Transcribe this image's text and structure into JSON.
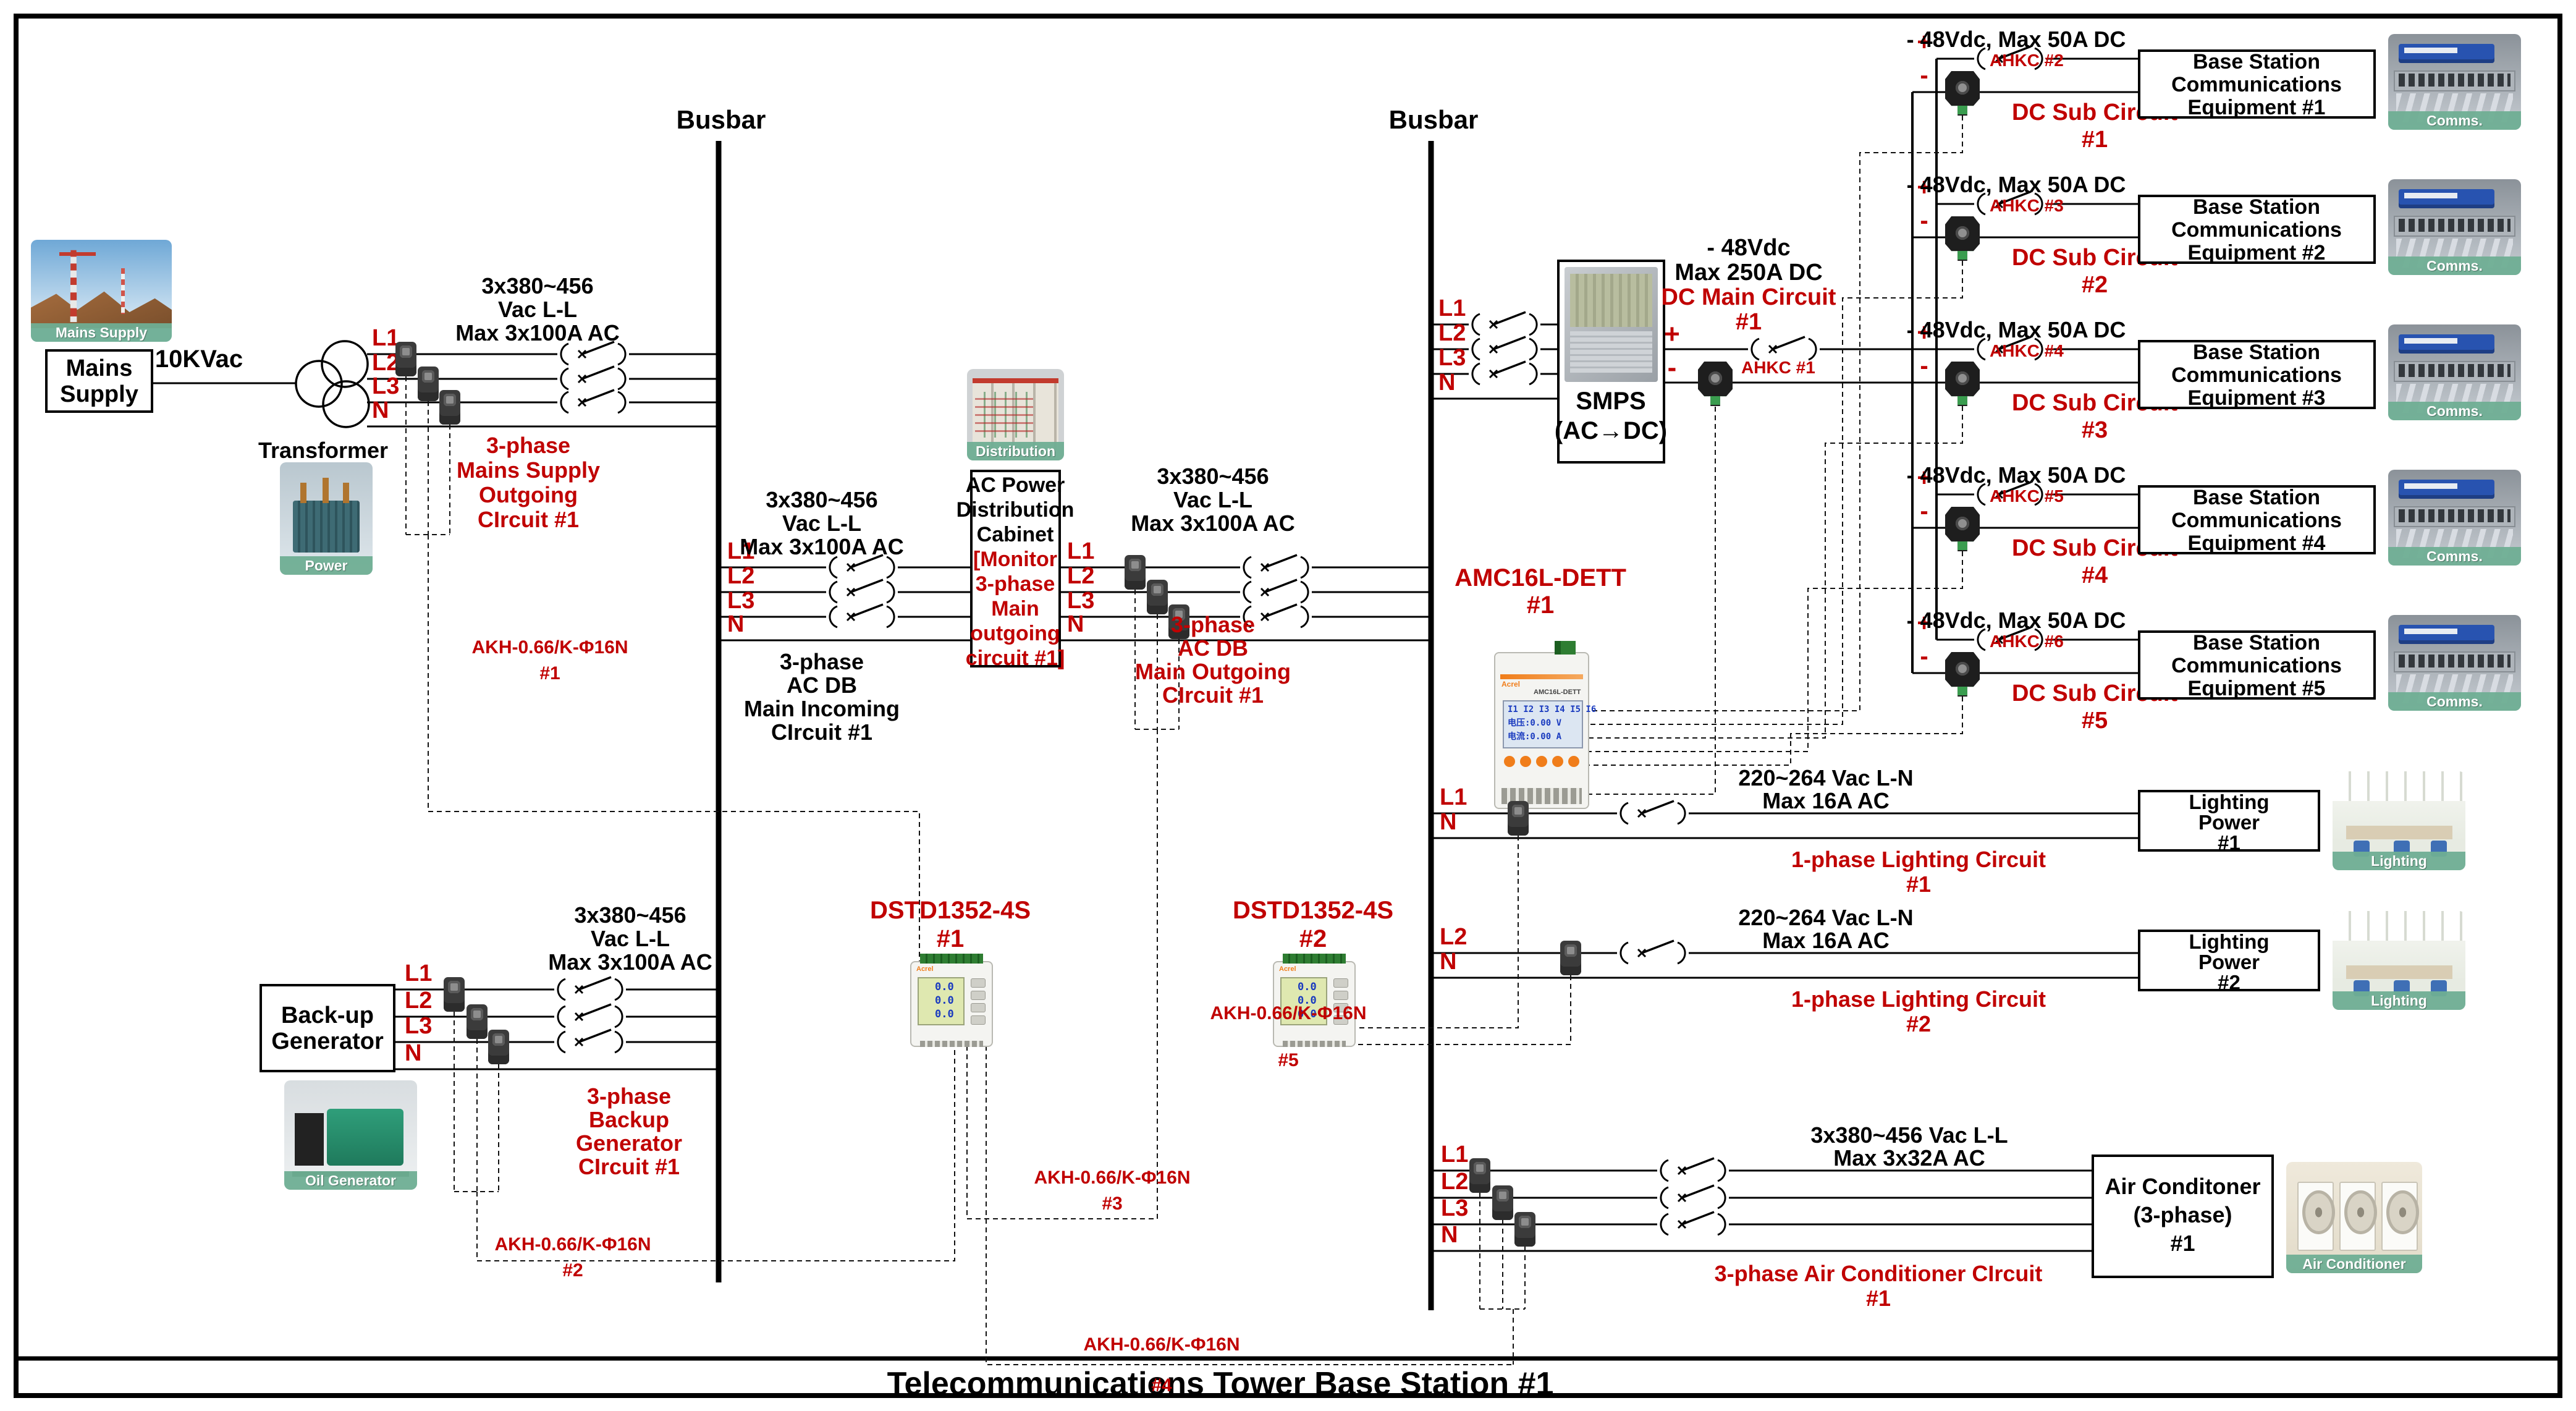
{
  "header": {
    "title": "Telecommunications Tower Base Station #1"
  },
  "busbar_label": "Busbar",
  "colors": {
    "red": "#c00000",
    "black": "#000000",
    "caption_green": "#6fae94"
  },
  "phases": [
    "L1",
    "L2",
    "L3",
    "N"
  ],
  "spec_380_100": [
    "3x380~456",
    "Vac L-L",
    "Max 3x100A AC"
  ],
  "mains": {
    "source_box": [
      "Mains",
      "Supply"
    ],
    "photo_caption": "Mains Supply",
    "voltage": "10KVac",
    "transformer_label": "Transformer",
    "transformer_photo_caption": "Power Transformer",
    "circuit": [
      "3-phase",
      "Mains Supply",
      "Outgoing",
      "CIrcuit #1"
    ]
  },
  "incoming": {
    "circuit": [
      "3-phase",
      "AC DB",
      "Main Incoming",
      "CIrcuit #1"
    ],
    "cabinet_black": [
      "AC Power",
      "Distribution",
      "Cabinet"
    ],
    "cabinet_red": [
      "[Monitor",
      "3-phase",
      "Main",
      "outgoing",
      "circuit #1]"
    ],
    "cabinet_photo_caption": "Distribution Cabinet"
  },
  "outgoing": {
    "circuit": [
      "3-phase",
      "AC DB",
      "Main Outgoing",
      "CIrcuit #1"
    ]
  },
  "generator": {
    "source_box": [
      "Back-up",
      "Generator"
    ],
    "photo_caption": "Oil Generator",
    "circuit": [
      "3-phase",
      "Backup",
      "Generator",
      "CIrcuit #1"
    ]
  },
  "smps": {
    "box": [
      "SMPS",
      "(AC→DC)"
    ],
    "spec_black": [
      "- 48Vdc",
      "Max 250A DC"
    ],
    "spec_red": [
      "DC Main Circuit",
      "#1"
    ],
    "plus": "+",
    "minus": "-",
    "ahkc": "AHKC #1"
  },
  "akh": {
    "model": "AKH-0.66/K-Φ16N",
    "nums": [
      "#1",
      "#2",
      "#3",
      "#4",
      "#5"
    ]
  },
  "dc_subcircuits": [
    {
      "spec": "- 48Vdc, Max 50A DC",
      "plus": "+",
      "minus": "-",
      "ahkc": "AHKC #2",
      "name": [
        "DC Sub Circuit",
        "#1"
      ],
      "equipment": [
        "Base Station",
        "Communications",
        "Equipment #1"
      ],
      "photo_caption": "Comms. Equipment"
    },
    {
      "spec": "- 48Vdc, Max 50A DC",
      "plus": "+",
      "minus": "-",
      "ahkc": "AHKC #3",
      "name": [
        "DC Sub Circuit",
        "#2"
      ],
      "equipment": [
        "Base Station",
        "Communications",
        "Equipment #2"
      ],
      "photo_caption": "Comms. Equipment"
    },
    {
      "spec": "- 48Vdc, Max 50A DC",
      "plus": "+",
      "minus": "-",
      "ahkc": "AHKC #4",
      "name": [
        "DC Sub Circuit",
        "#3"
      ],
      "equipment": [
        "Base Station",
        "Communications",
        "Equipment #3"
      ],
      "photo_caption": "Comms. Equipment"
    },
    {
      "spec": "- 48Vdc, Max 50A DC",
      "plus": "+",
      "minus": "-",
      "ahkc": "AHKC #5",
      "name": [
        "DC Sub Circuit",
        "#4"
      ],
      "equipment": [
        "Base Station",
        "Communications",
        "Equipment #4"
      ],
      "photo_caption": "Comms. Equipment"
    },
    {
      "spec": "- 48Vdc, Max 50A DC",
      "plus": "+",
      "minus": "-",
      "ahkc": "AHKC #6",
      "name": [
        "DC Sub Circuit",
        "#5"
      ],
      "equipment": [
        "Base Station",
        "Communications",
        "Equipment #5"
      ],
      "photo_caption": "Comms. Equipment"
    }
  ],
  "lighting": [
    {
      "phase": "L1",
      "neutral": "N",
      "spec": [
        "220~264 Vac L-N",
        "Max 16A AC"
      ],
      "circuit": [
        "1-phase Lighting Circuit",
        "#1"
      ],
      "box": [
        "Lighting",
        "Power",
        "#1"
      ],
      "photo_caption": "Lighting"
    },
    {
      "phase": "L2",
      "neutral": "N",
      "spec": [
        "220~264 Vac L-N",
        "Max 16A AC"
      ],
      "circuit": [
        "1-phase Lighting Circuit",
        "#2"
      ],
      "box": [
        "Lighting",
        "Power",
        "#2"
      ],
      "photo_caption": "Lighting"
    }
  ],
  "aircon": {
    "spec": [
      "3x380~456 Vac L-L",
      "Max 3x32A AC"
    ],
    "circuit": [
      "3-phase Air Conditioner CIrcuit",
      "#1"
    ],
    "box": [
      "Air Conditoner",
      "(3-phase)",
      "#1"
    ],
    "photo_caption": "Air Conditioner"
  },
  "meters": {
    "brand": "Acrel",
    "dstd": [
      {
        "model": "DSTD1352-4S",
        "num": "#1"
      },
      {
        "model": "DSTD1352-4S",
        "num": "#2"
      }
    ],
    "amc": {
      "model": "AMC16L-DETT",
      "num": "#1"
    },
    "dstd_display": [
      "0.0",
      "0.0",
      "0.0"
    ],
    "amc_display": [
      "I1 I2 I3 I4 I5 I6",
      "电压:0.00  V",
      "电流:0.00  A"
    ]
  }
}
